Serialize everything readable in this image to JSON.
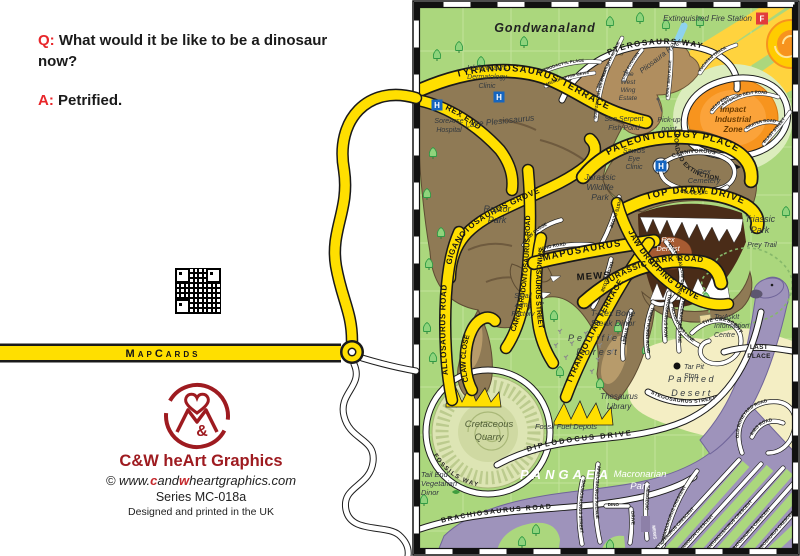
{
  "card": {
    "q_prefix": "Q:",
    "question": "What would it be like to be a dinosaur now?",
    "a_prefix": "A:",
    "answer": "Petrified.",
    "banner": "MapCards",
    "brand": "C&W heArt Graphics",
    "site": {
      "pre": "© www.",
      "c": "c",
      "mid": "and",
      "w": "w",
      "post": "heartgraphics.com"
    },
    "series": "Series MC-018a",
    "printed": "Designed and printed in the UK",
    "logo_amp": "&",
    "colors": {
      "accent_red": "#E8262A",
      "brand_red": "#9E1B20",
      "road_yellow": "#FFDF00"
    }
  },
  "map": {
    "title": "Gondwanaland",
    "water": {
      "lake": "Lake Plesiosaurus",
      "river": "Pliosaura River",
      "pond1": "Sea Serpent",
      "pond2": "Fish Pond"
    },
    "markers": {
      "h": "H",
      "f": "F"
    },
    "places": {
      "ichthyosaurs": [
        "Ichthyosaurs",
        "Dermatology",
        "Clinic"
      ],
      "sorearse": [
        "SoreArse",
        "Hospital"
      ],
      "pickup": [
        "Pick-up",
        "point"
      ],
      "fire_station": "Extinguished Fire Station",
      "west_wing": [
        "The",
        "West",
        "Wing",
        "Estate"
      ],
      "impact": [
        "Impact",
        "Industrial",
        "Zone"
      ],
      "raptor_park": [
        "Raptor",
        "Park"
      ],
      "jurassic_wildlife": [
        "Jurassic",
        "Wildlife",
        "Park"
      ],
      "sawus": [
        "SawUs",
        "Eye",
        "Clinic"
      ],
      "rex_cemetery": [
        "Rex",
        "Cemetery"
      ],
      "rex_dentist": [
        "Rex",
        "Dentist"
      ],
      "triassic_park": [
        "Triassic",
        "Park"
      ],
      "prey_trail": "Prey Trail",
      "small_arms": [
        "Small",
        "Arms",
        "Factory"
      ],
      "trex_steak": [
        "T-Rex Bone",
        "Steak Dinor"
      ],
      "petrified": [
        "Petrified",
        "Forest"
      ],
      "thesaurus": [
        "Thesaurus",
        "Library"
      ],
      "fossil_fuel": "Fossil Fuel Depots",
      "tryaskit": [
        "TryAskIt",
        "Information",
        "Centre"
      ],
      "tar_pit": [
        "Tar Pit",
        "Stop"
      ],
      "painted": [
        "Painted",
        "Desert"
      ],
      "cretaceous": [
        "Cretaceous",
        "Quarry"
      ],
      "tail_end": [
        "Tail End",
        "Vegetarian",
        "Dinor"
      ],
      "pangaea": "PANGAEA",
      "macronarian": [
        "Macronarian",
        "Park"
      ]
    },
    "roads": {
      "tyrannosaurus": "TYRANNOSAURUS TERRACE",
      "rex_end": "REX END",
      "giganotosaurus": "GIGANOTOSAURUS GROVE",
      "carcharodontosaurus": "CARCHARODONTOSAURUS ROAD",
      "allosaurus": "ALLOSAURUS ROAD",
      "claw_close_y": "CLAW CLOSE",
      "spinosaurus": "SPINOSAURUS STREET",
      "mapusaurus": "MAPUSAURUS",
      "mapusaurus2": "MEWS",
      "tyrannotitan": "TYRANNOTITAN TERRACE",
      "jurassic": "JURASSIC PARK ROAD",
      "paleontology": "PALEONTOLOGY PLACE",
      "top_draw": "TOP DRAW DRIVE",
      "jaw_dropping": "JAW DROPPING DRIVE",
      "pterosaurs": "PTEROSAURS WAY",
      "extinction": "ROAD TO EXTINCTION",
      "yucatan": "YUCATAN TRACK",
      "asteroid": "ASTEROID BELT ROAD",
      "dead_end": "DEAD END",
      "crater": "CRATER ROAD",
      "blast": "BLAST STREET",
      "pterodactyl": "PTERODACTYL PLACE",
      "microraptor": "MICRORAPTOR MEWS",
      "archaeopteryx": "ARCHAEOPTERYX AVENUE",
      "quetzalcoatlus": "QUETZALCOATLUS STREET",
      "early_bird": "EARLY BIRD PLACE",
      "last_flydown": "LAST FLYDOWN",
      "carnivorous": "CARNIVOROUS",
      "cul_de_sac": "CUL-DE-SAC",
      "last_swallow": "LAST SWALLOW CLOSE",
      "hand": "HAND ROAD",
      "claw_close_w": "CLAW CLOSE",
      "fists": "FISTS CLOSE",
      "talon": "TALON CLOSE",
      "the_crescent": "THE CRESCENT",
      "last_place": [
        "LAST",
        "PLACE"
      ],
      "alligators": "ALLIGATORS LANE",
      "three_horns": "THREE HORNS ROAD",
      "triceratops": "TRICERATOPS LANE",
      "torosaurus": "TOROSAURUS ROW",
      "beak": "BEAK STREET",
      "stegosaurus": "STEGOSAURUS STREET",
      "fossils_way": "FOSSILS WAY",
      "diplodocus": "DIPLODOCUS DRIVE",
      "brachiosaurus": "BRACHIOSAURUS ROAD",
      "shunosaurus": "SHUNOSAURUS STREET",
      "apatosaurus": "APATOSAURUS AVENUE",
      "dino": [
        "DINO",
        "DRIVE"
      ],
      "mesozoic": [
        "MESOZOIC",
        "MEWS"
      ],
      "old_boneyard": "OLD BONEYARD ROAD",
      "ribs": "RIBS ROAD",
      "crescents": [
        "CAMARASAURUS CRESCENT",
        "ANKYLOSAURUS CRESCENT",
        "IGUANODON CRESCENT",
        "SHANTUNGOSAURUS CRESCENT",
        "CERATOSAURUS CRESCENT",
        "HADROSAURUS CRESCENT"
      ]
    }
  }
}
